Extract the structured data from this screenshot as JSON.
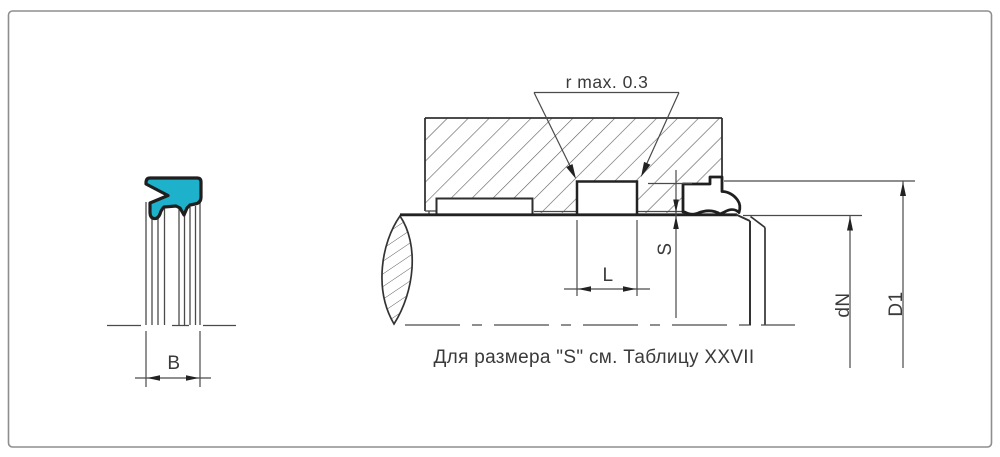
{
  "labels": {
    "corner_radius": "r  max. 0.3",
    "groove_length": "L",
    "groove_depth": "S",
    "seal_width": "B",
    "shaft_diameter": "dN",
    "bore_diameter": "D1"
  },
  "note": "Для размера \"S\" см. Таблицу XXVII",
  "colors": {
    "seal_fill": "#1eb1cb",
    "seal_outline": "#1f1f1f",
    "line_medium": "#333333",
    "line_thin": "#4a4a4a",
    "hatch": "#606060",
    "arrow": "#222222",
    "frame": "#8e8e8e",
    "text": "#3a3a3a"
  }
}
